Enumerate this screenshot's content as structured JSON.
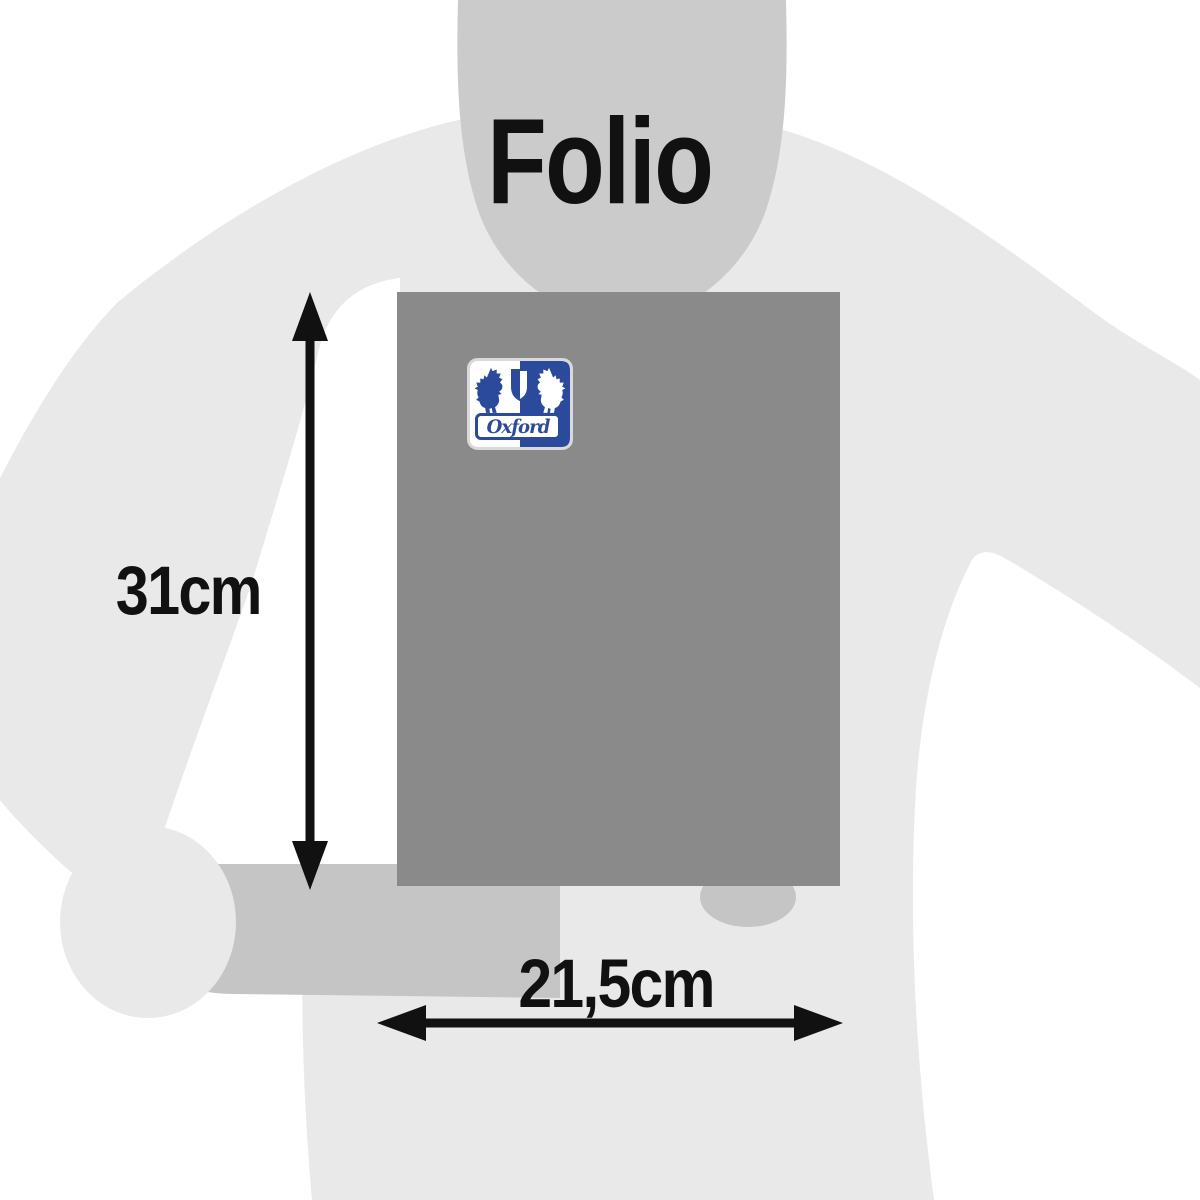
{
  "title": "Folio",
  "dimensions": {
    "height": "31cm",
    "width": "21,5cm"
  },
  "logo": {
    "brand": "Oxford",
    "blue": "#2b4a9c",
    "white": "#ffffff"
  },
  "product": {
    "kind": "notebook-cover",
    "color": "#8a8a8a"
  },
  "silhouette": {
    "body_color": "#e9e9e9",
    "head_color": "#cbcbcb",
    "arm_color": "#c5c5c5"
  },
  "annotation_color": "#111111",
  "background_color": "#ffffff"
}
